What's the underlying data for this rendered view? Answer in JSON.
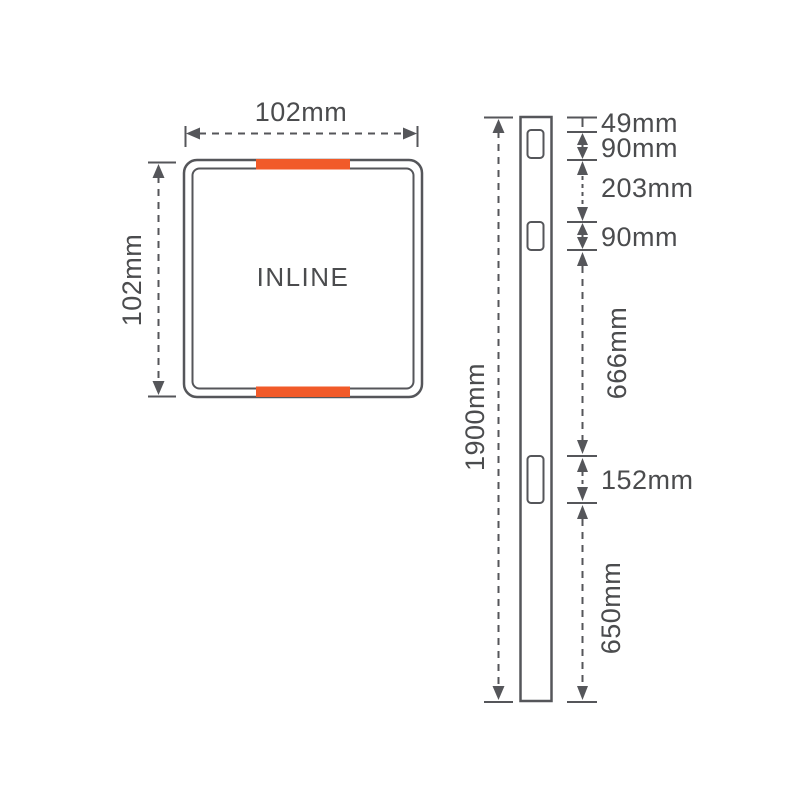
{
  "colors": {
    "line": "#55565a",
    "text": "#4b4c4e",
    "accent": "#f15a29",
    "background": "#ffffff"
  },
  "front_view": {
    "label": "INLINE",
    "width_dim": "102mm",
    "height_dim": "102mm"
  },
  "side_view": {
    "total_height_dim": "1900mm",
    "dims": {
      "top_to_slot1": "49mm",
      "slot1_height": "90mm",
      "slot1_to_slot2": "203mm",
      "slot2_height": "90mm",
      "slot2_to_slot3": "666mm",
      "slot3_height": "152mm",
      "slot3_to_bottom": "650mm"
    }
  }
}
